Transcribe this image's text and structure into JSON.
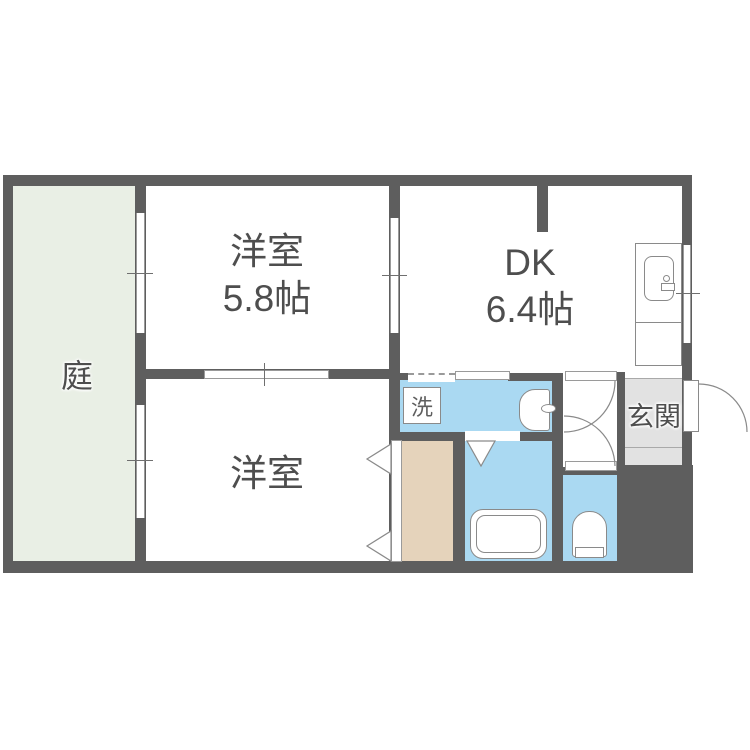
{
  "floorplan": {
    "title": "2DK apartment floor plan",
    "rooms": {
      "garden": {
        "label": "庭"
      },
      "western1": {
        "label": "洋室",
        "size": "5.8帖"
      },
      "dk": {
        "label": "DK",
        "size": "6.4帖"
      },
      "western2": {
        "label": "洋室"
      },
      "entrance": {
        "label": "玄関"
      },
      "laundry": {
        "label": "洗"
      }
    },
    "colors": {
      "wall": "#5e5e5e",
      "garden": "#e9efe5",
      "water_area": "#aad9f2",
      "closet": "#e5d3bb",
      "entrance_floor": "#e2e2e2",
      "fixture_outline": "#8a8a8a",
      "text": "#4e4e4e",
      "background": "#ffffff"
    }
  }
}
